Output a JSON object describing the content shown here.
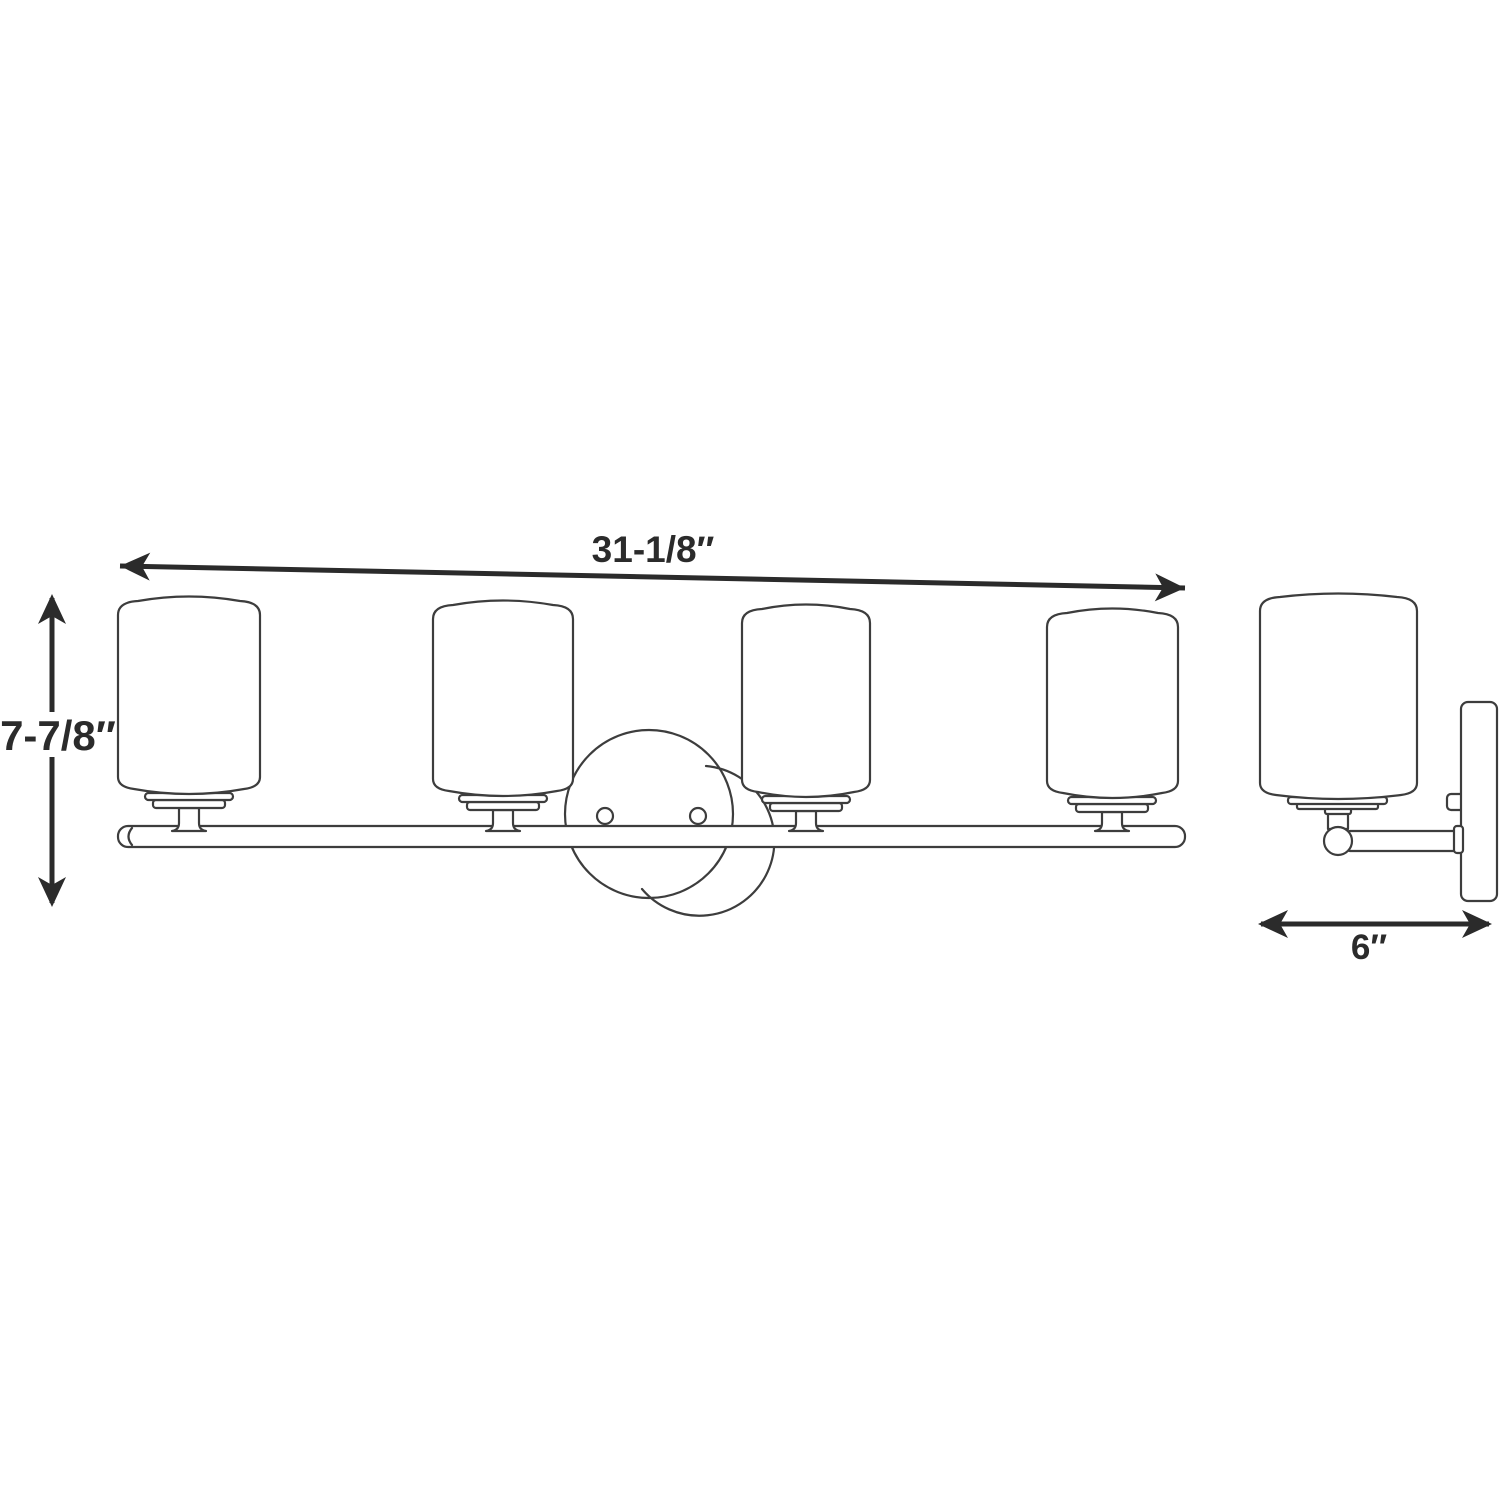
{
  "labels": {
    "width": "31-1/8″",
    "height": "7-7/8″",
    "depth": "6″"
  },
  "colors": {
    "background": "#ffffff",
    "fixture_line": "#3d3d3d",
    "dimension_line": "#2b2b2b",
    "text": "#2b2b2b"
  },
  "front_view": {
    "shade_count": 4,
    "mount_screw_holes": 2
  },
  "side_view": {
    "shade_count": 1
  }
}
